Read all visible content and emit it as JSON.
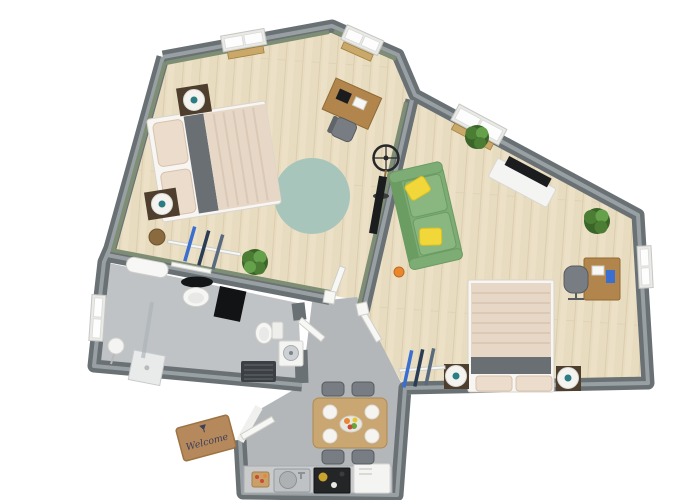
{
  "scene": {
    "type": "3d-floor-plan-top-view",
    "background": "#ffffff"
  },
  "doormat": {
    "text": "Welcome"
  },
  "colors": {
    "wood": "#e8dcc0",
    "plank": "#d8c9a8",
    "floorGray": "#b4b7b9",
    "floorGrayLight": "#c0c3c5",
    "wall": "#6a7175",
    "wallTop": "#99a0a3",
    "wallGreen": "#7e8e74",
    "rug": "#a8c5bc",
    "bedFrame": "#f8f6f3",
    "linen": "#e7d7c7",
    "stripe": "#dbc9b6",
    "darkBand": "#696f73",
    "pillowBeige": "#ecdccc",
    "nightstand": "#4e3e2d",
    "lamp": "#f4f3f0",
    "lampDot": "#2a7d82",
    "sofa": "#7dac74",
    "sofaDark": "#6b9c62",
    "sofaLight": "#8ab780",
    "pillowYellow": "#f1d73a",
    "tv": "#1a1c1e",
    "tvStand": "#f4f4f2",
    "plantDark": "#3a6428",
    "plantMid": "#4c7d35",
    "plantLight": "#65a04a",
    "desk": "#b2854c",
    "deskDark": "#8f6a35",
    "chairGray": "#777d82",
    "table": "#c9a672",
    "plate": "#f5f4f1",
    "mat": "#b5895c",
    "matText": "#3c3f5c",
    "ski1": "#3a6fd0",
    "ski2": "#2b3d55",
    "ski3": "#5a6a7e",
    "counter": "#c8cacc",
    "steel": "#bfc2c4",
    "cooktop": "#232527",
    "fridge": "#f4f4f3",
    "radiator": "#3c4044",
    "doorLeaf": "#f7f7f5",
    "windowFrame": "#e9e9e7",
    "basket": "#8a6a3f",
    "orangeStool": "#e8872f",
    "fruitOrange": "#e8872f",
    "fruitGreen": "#6aa33c",
    "fruitRed": "#c84b32",
    "fruitYellow": "#e8c832"
  },
  "rooms": [
    {
      "name": "Bedroom",
      "floor": "wood",
      "furniture": [
        "double bed with beige bedding",
        "2 dark nightstands with white lamps",
        "round teal rug",
        "desk with chair in window nook",
        "wall-mounted TV",
        "pedestal fan",
        "skis against wall",
        "potted plant",
        "basket"
      ]
    },
    {
      "name": "Living room with sleeping area",
      "floor": "wood",
      "furniture": [
        "green sofa with 2 yellow pillows",
        "white sideboard with TV",
        "double bed with beige bedding",
        "2 nightstands with lamps",
        "desk with office chair",
        "2 potted plants",
        "skis with wall shelf",
        "small orange stool"
      ]
    },
    {
      "name": "Bathroom",
      "floor": "gray tile",
      "furniture": [
        "walk-in shower with glass panel",
        "sink with black oval mirror",
        "black cabinet",
        "toilet",
        "washing machine",
        "dark radiator",
        "white stool",
        "towel bar"
      ]
    },
    {
      "name": "Kitchen / dining",
      "floor": "gray tile",
      "furniture": [
        "dining table with 4 plates and fruit platter",
        "4 gray chairs",
        "kitchen counter",
        "steel sink",
        "black cooktop",
        "white appliance"
      ]
    },
    {
      "name": "Hall",
      "floor": "gray tile",
      "furniture": [
        "entry door",
        "welcome doormat"
      ]
    }
  ],
  "windows_count": 5,
  "doors": {
    "entry": 1,
    "interior": 3
  }
}
